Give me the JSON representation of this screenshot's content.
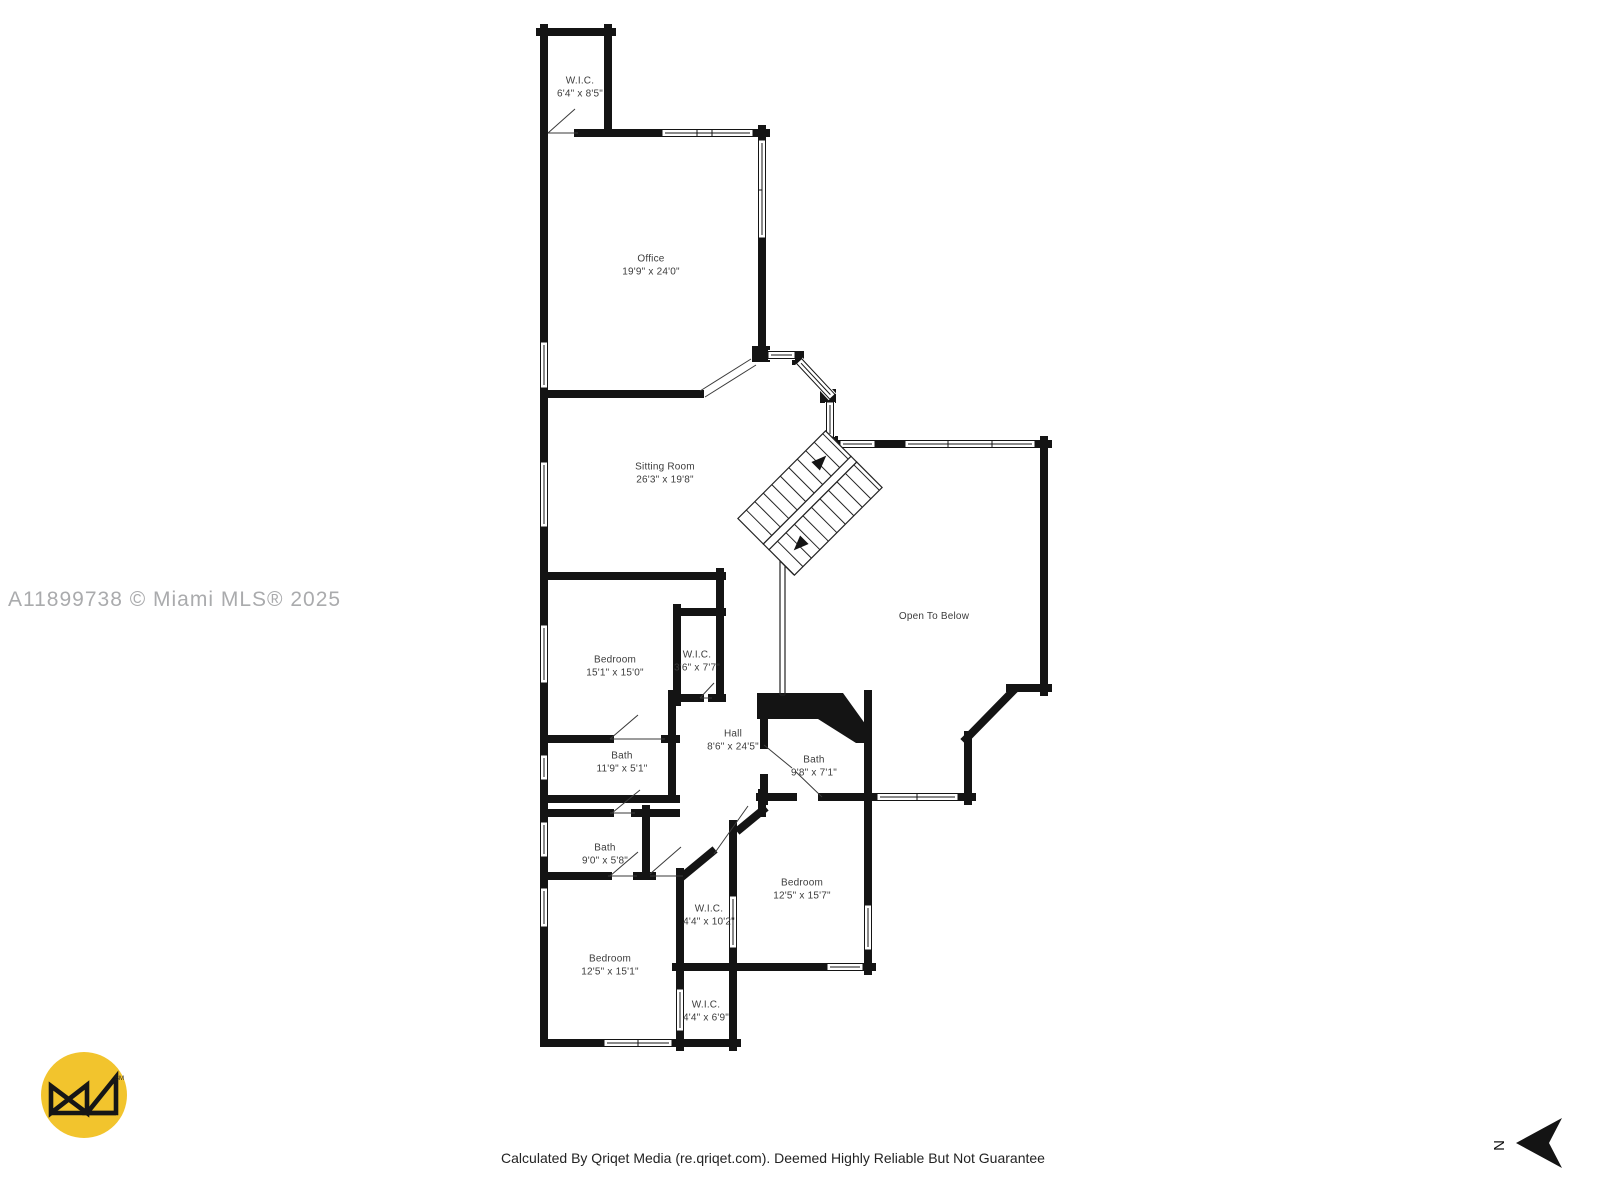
{
  "watermark": "A11899738 © Miami MLS® 2025",
  "footer": {
    "caption": "Calculated By Qriqet Media (re.qriqet.com). Deemed Highly Reliable But Not Guarantee"
  },
  "compass": {
    "letter": "N"
  },
  "logo": {
    "trademark": "SM",
    "color": "#F2C42D"
  },
  "colors": {
    "walls": "#141414",
    "watermark": "#aaabad",
    "label_text": "#3c3c3c"
  },
  "rooms": [
    {
      "name": "W.I.C.",
      "dims": "6'4\" x 8'5\""
    },
    {
      "name": "Office",
      "dims": "19'9\" x 24'0\""
    },
    {
      "name": "Sitting Room",
      "dims": "26'3\" x 19'8\""
    },
    {
      "name": "Bedroom",
      "dims": "15'1\" x 15'0\""
    },
    {
      "name": "W.I.C.",
      "dims": "3'6\" x 7'7\""
    },
    {
      "name": "Hall",
      "dims": "8'6\" x 24'5\""
    },
    {
      "name": "Bath",
      "dims": "11'9\" x 5'1\""
    },
    {
      "name": "Bath",
      "dims": "9'8\" x 7'1\""
    },
    {
      "name": "Open To Below",
      "dims": ""
    },
    {
      "name": "Bath",
      "dims": "9'0\" x 5'8\""
    },
    {
      "name": "Bedroom",
      "dims": "12'5\" x 15'7\""
    },
    {
      "name": "W.I.C.",
      "dims": "4'4\" x 10'2\""
    },
    {
      "name": "Bedroom",
      "dims": "12'5\" x 15'1\""
    },
    {
      "name": "W.I.C.",
      "dims": "4'4\" x 6'9\""
    }
  ]
}
